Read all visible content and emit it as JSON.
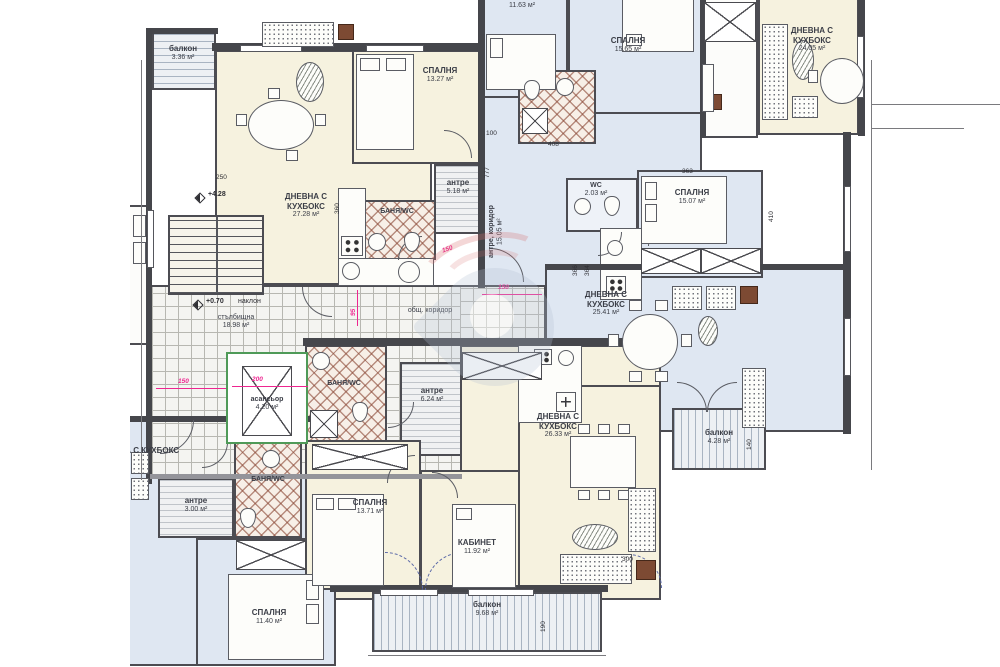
{
  "plan": {
    "type": "architectural-floor-plan",
    "language": "bg",
    "colors": {
      "apartment_cream": "#f6f2df",
      "apartment_blue": "#dfe7f2",
      "wet_room_hatch": "#8c4a38",
      "common_tiles": "#f4f4f1",
      "walls": "#45464b",
      "elevator_green": "#4f9a58",
      "dimension_pink": "#ee2690"
    }
  },
  "rooms": [
    {
      "label": "балкон",
      "area": "3.36 м²"
    },
    {
      "label": "СПАЛНЯ",
      "area": "13.27 м²"
    },
    {
      "label": "ДНЕВНА С КУХБОКС",
      "area": "27.28 м²"
    },
    {
      "label": "антре",
      "area": "5.18 м²"
    },
    {
      "label": "БАНЯ/WC",
      "area": ""
    },
    {
      "label": "",
      "area": "11.63 м²"
    },
    {
      "label": "СПАЛНЯ",
      "area": "15.65 м²"
    },
    {
      "label": "ДНЕВНА С КУХБОКС",
      "area": "24.05 м²"
    },
    {
      "label": "антре, коридор",
      "area": "15.05 м²"
    },
    {
      "label": "WC",
      "area": "2.03 м²"
    },
    {
      "label": "СПАЛНЯ",
      "area": "15.07 м²"
    },
    {
      "label": "ДНЕВНА С КУХБОКС",
      "area": "25.41 м²"
    },
    {
      "label": "балкон",
      "area": "4.28 м²"
    },
    {
      "label": "общ. коридор",
      "area": ""
    },
    {
      "label": "стълбищна",
      "area": "18.98 м²"
    },
    {
      "label": "асансьор",
      "area": "4.20 м²"
    },
    {
      "label": "антре",
      "area": "3.00 м²"
    },
    {
      "label": "БАНЯ/WC",
      "area": ""
    },
    {
      "label": "СПАЛНЯ",
      "area": "11.40 м²"
    },
    {
      "label": "ДНЕВНА С КУХБОКС",
      "area": ""
    },
    {
      "label": "СПАЛНЯ",
      "area": "13.71 м²"
    },
    {
      "label": "антре",
      "area": "6.24 м²"
    },
    {
      "label": "БАНЯ/WC",
      "area": ""
    },
    {
      "label": "КАБИНЕТ",
      "area": "11.92 м²"
    },
    {
      "label": "ДНЕВНА С КУХБОКС",
      "area": "26.33 м²"
    },
    {
      "label": "балкон",
      "area": "9.68 м²"
    }
  ],
  "levels": {
    "stair_upper": "+4.28",
    "corridor": "+0.70",
    "slope_note": "наклон"
  },
  "dims": [
    "250",
    "360",
    "408",
    "100",
    "777",
    "363",
    "410",
    "366",
    "364",
    "300",
    "140",
    "190"
  ],
  "pink_dims": [
    "150",
    "200",
    "150",
    "150",
    "95"
  ]
}
